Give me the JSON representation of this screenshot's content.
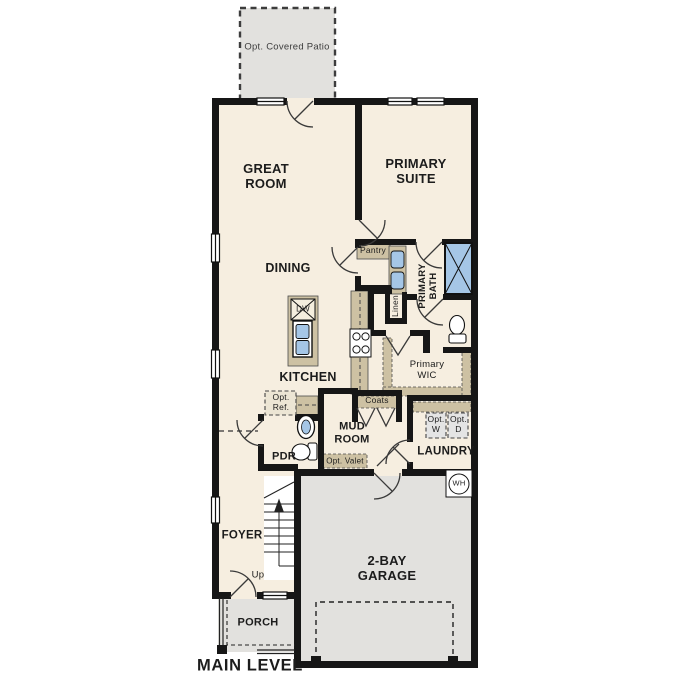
{
  "plan": {
    "title": "MAIN LEVEL",
    "rooms": {
      "patio": "Opt. Covered Patio",
      "great_room": "GREAT ROOM",
      "primary_suite": "PRIMARY SUITE",
      "dining": "DINING",
      "kitchen": "KITCHEN",
      "pantry": "Pantry",
      "primary_bath": "PRIMARY BATH",
      "linen": "Linen",
      "primary_wic": "Primary WIC",
      "coats": "Coats",
      "mud_room": "MUD ROOM",
      "laundry": "LAUNDRY",
      "pdr": "PDR",
      "foyer": "FOYER",
      "porch": "PORCH",
      "garage": "2-BAY GARAGE"
    },
    "features": {
      "opt_ref": "Opt. Ref.",
      "opt_valet": "Opt. Valet",
      "opt_washer": "Opt. W",
      "opt_dryer": "Opt. D",
      "dishwasher": "DW",
      "water_heater": "WH",
      "stairs_up": "Up"
    },
    "colors": {
      "floor": "#f6eee0",
      "outdoor": "#e2e1de",
      "wall": "#161616",
      "cabinet": "#cdc1a3",
      "fixture_blue": "#a5c6e6",
      "text": "#1c1c1c",
      "line": "#333333"
    }
  }
}
